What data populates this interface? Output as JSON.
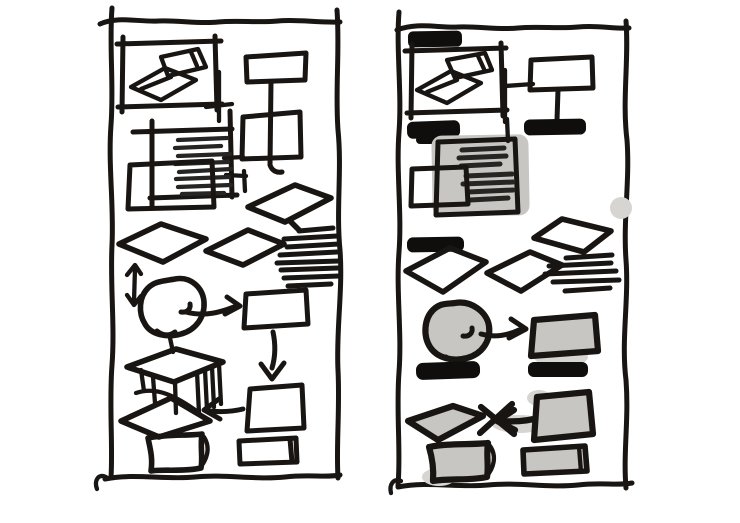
{
  "colors": {
    "background": "#ffffff",
    "ink": "#181512",
    "bar": "#100e0c",
    "gray": "#c8c6c3",
    "smudge": "#d7d5d2",
    "scribble": "#272523"
  },
  "panels": [
    {
      "id": "left-wireframe",
      "label": "left hand-drawn wireframe sketch, outline only",
      "elements": [
        "panel-border",
        "bed",
        "bed-connector",
        "sign-stand",
        "text-block-with-lines",
        "overlap-square",
        "tilted-cards",
        "scribble-text-lines",
        "vertical-double-arrow",
        "circle",
        "arrow-right",
        "rectangle",
        "arrow-down",
        "square",
        "crossed-arrow-left",
        "cube",
        "tilted-card",
        "pillow-rectangle",
        "small-rectangle"
      ]
    },
    {
      "id": "right-wireframe",
      "label": "right hand-drawn wireframe sketch, shaded with black label bars",
      "elements": [
        "panel-border",
        "title-bar",
        "bed",
        "bed-connector",
        "sign-stand",
        "stand-base-bar",
        "label-bars",
        "shaded-text-block",
        "smudge-dot",
        "tilted-cards",
        "scribble-text-lines",
        "shaded-circle",
        "arrow-right",
        "shaded-rectangle",
        "shaded-diamond",
        "crossed-arrow-left",
        "shaded-square",
        "shaded-pillow-rectangle",
        "shaded-small-rectangle"
      ]
    }
  ]
}
